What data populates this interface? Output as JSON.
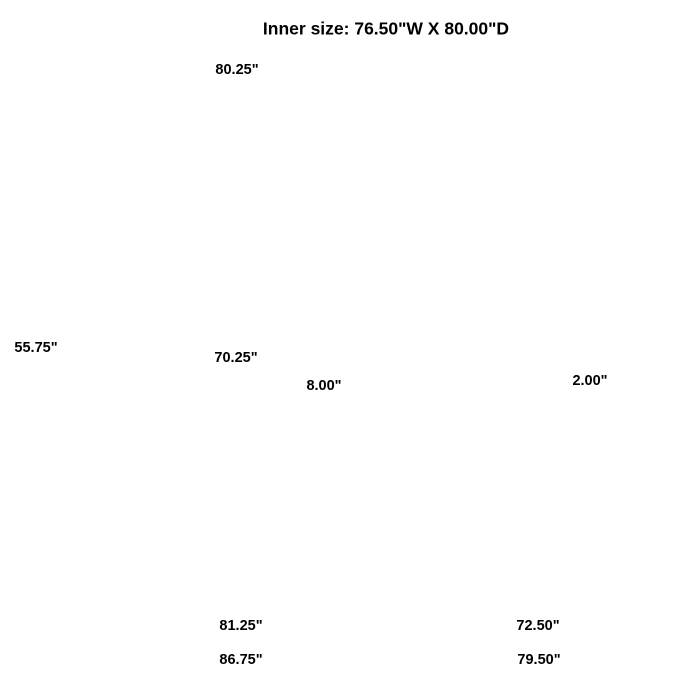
{
  "title": "Inner size: 76.50\"W X 80.00\"D",
  "dims": {
    "headboard_width": "80.25\"",
    "headboard_height": "55.75\"",
    "inner_width": "70.25\"",
    "slat_spacing": "8.00\"",
    "slat_thickness": "2.00\"",
    "base_width": "81.25\"",
    "base_depth": "72.50\"",
    "overall_width": "86.75\"",
    "overall_depth": "79.50\""
  },
  "figure": {
    "slat_count": 20,
    "tuft_columns": 8,
    "tuft_rows": 5,
    "rail_panels_per_side": 4
  },
  "colors": {
    "line": "#474747",
    "dimension": "#1a1a1a",
    "text": "#000000",
    "background": "#ffffff"
  }
}
